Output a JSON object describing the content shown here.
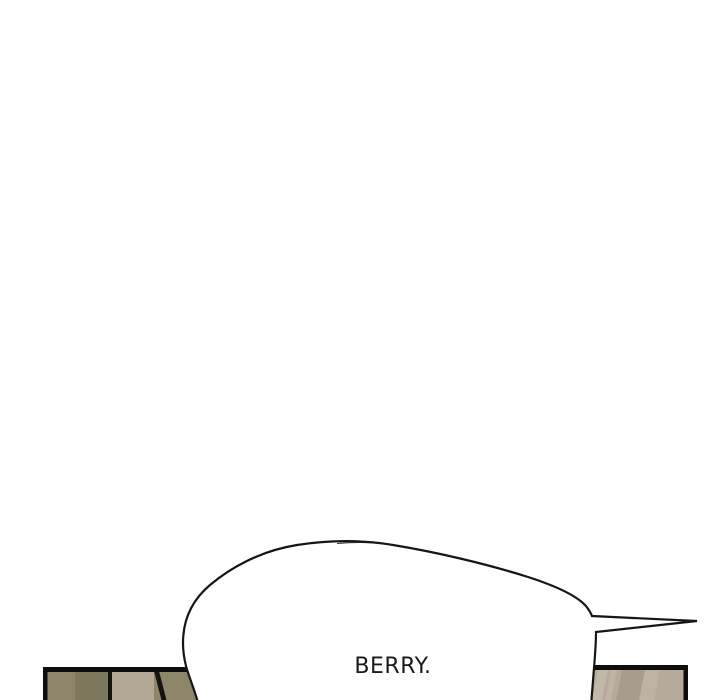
{
  "scene": {
    "type": "webtoon-comic-strip-segment",
    "background_color": "#ffffff",
    "speech_bubble": {
      "text": "BERRY.",
      "fill_color": "#ffffff",
      "outline_color": "#161616",
      "tail_direction": "right"
    },
    "next_panel": {
      "border_color": "#0e0e0e",
      "left_section": {
        "stripe1_color": "#8d8569",
        "stripe2_color": "#7e785e",
        "stripe3_color": "#b2a795",
        "stripe4_color": "#8d8569",
        "divider_color": "#151310"
      },
      "right_section": {
        "base_color": "#b5aa9b",
        "streak_light_color": "#c2b8aa",
        "streak_faint_color": "#bfb4a6",
        "band_dark_color": "#a89c8e",
        "band_light_color": "#bdb3a5"
      }
    }
  }
}
